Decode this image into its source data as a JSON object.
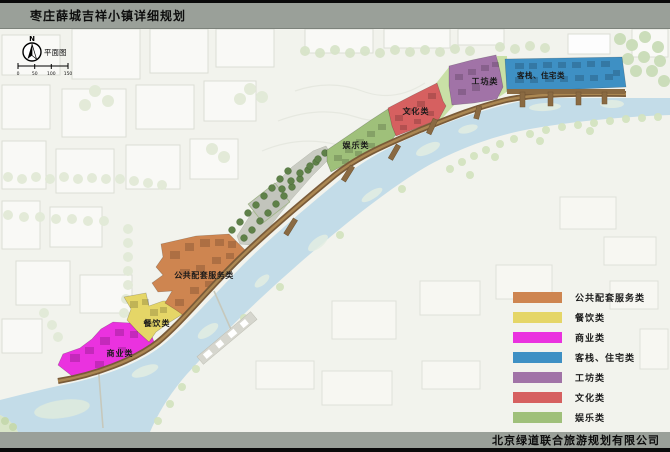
{
  "header": {
    "title": "枣庄薛城吉祥小镇详细规划"
  },
  "footer": {
    "company": "北京绿道联合旅游规划有限公司"
  },
  "compass": {
    "north_label": "N",
    "plan_view_label": "平面图"
  },
  "scale_bar": {
    "ticks": [
      "0",
      "50",
      "100",
      "150"
    ]
  },
  "legend": {
    "items": [
      {
        "id": "public-service",
        "label": "公共配套服务类",
        "color": "#CE8550"
      },
      {
        "id": "dining",
        "label": "餐饮类",
        "color": "#E5D667"
      },
      {
        "id": "commercial",
        "label": "商业类",
        "color": "#EA32DF"
      },
      {
        "id": "inn-residence",
        "label": "客栈、住宅类",
        "color": "#3E90C4"
      },
      {
        "id": "workshop",
        "label": "工坊类",
        "color": "#A173A7"
      },
      {
        "id": "culture",
        "label": "文化类",
        "color": "#D66060"
      },
      {
        "id": "entertainment",
        "label": "娱乐类",
        "color": "#9FC07A"
      }
    ]
  },
  "map_labels": {
    "commercial": "商业类",
    "dining": "餐饮类",
    "public_service": "公共配套服务类",
    "entertainment": "娱乐类",
    "culture": "文化类",
    "workshop": "工坊类",
    "inn_residence": "客栈、住宅类"
  }
}
